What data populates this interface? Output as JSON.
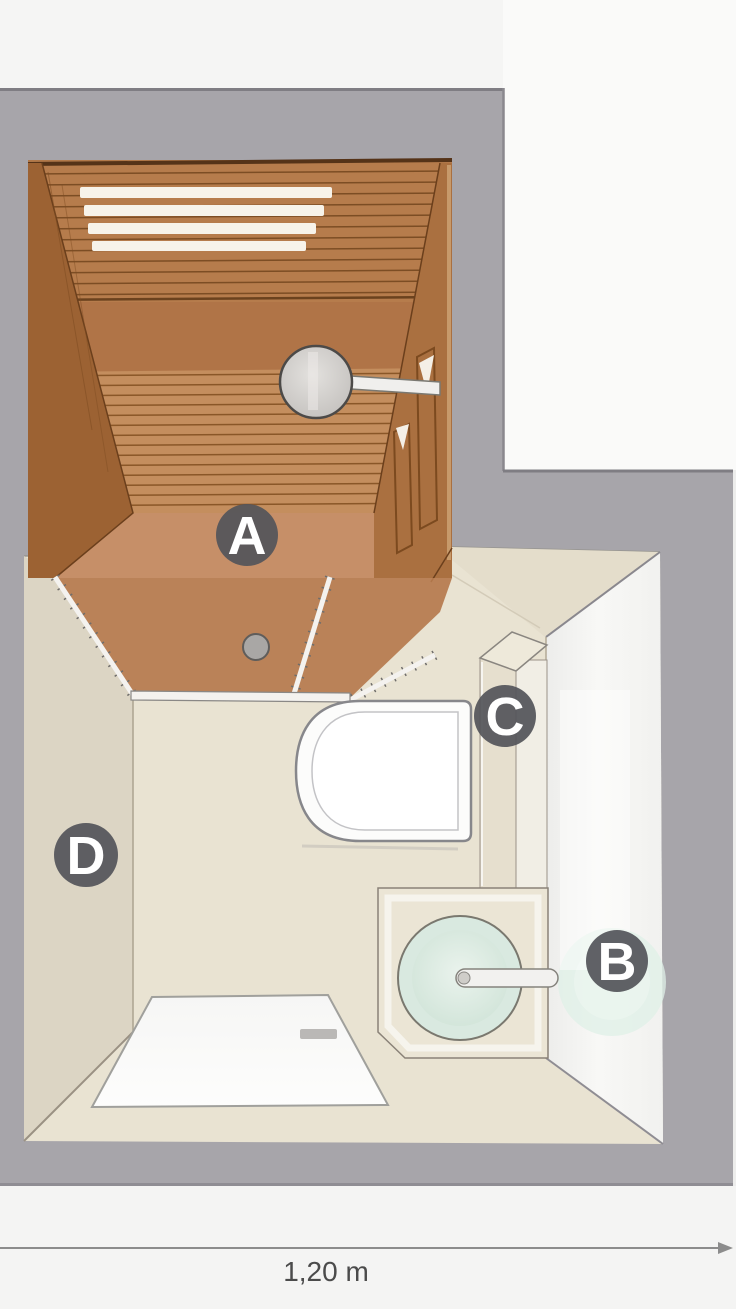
{
  "diagram": {
    "markers": [
      {
        "letter": "A"
      },
      {
        "letter": "B"
      },
      {
        "letter": "C"
      },
      {
        "letter": "D"
      }
    ],
    "dimension": {
      "label": "1,20 m"
    },
    "colors": {
      "wall_gray": "#a7a5aa",
      "wall_edge": "#7f7d83",
      "marker_bg": "#54555a",
      "marker_text": "#ffffff",
      "sauna_wood": "#b1794a",
      "sauna_bench": "#c48e5e",
      "sauna_floor": "#c68f68",
      "bath_floor": "#e9e3d2",
      "left_wall_face": "#dcd5c4",
      "mirror_wall": "#f3f3f1",
      "basin_mint": "#d9e9e0",
      "mat_white": "#fafaf9",
      "toilet_white": "#fcfcfb",
      "dimension_line": "#8c8c8c",
      "dimension_text": "#4b4b4b"
    }
  }
}
